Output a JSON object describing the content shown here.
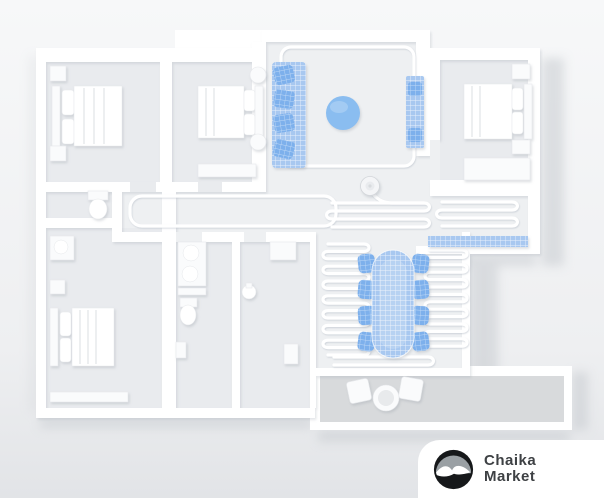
{
  "logo": {
    "brand_line1": "Chaika",
    "brand_line2": "Market",
    "icon": "seagull-icon"
  },
  "colors": {
    "bgTop": "#f7f8f9",
    "bgMid": "#eeeff1",
    "bgBottom": "#e2e4e7",
    "wall": "#ffffff",
    "floor": "#e9ebee",
    "floorLight": "#eef0f2",
    "balconyFloor": "#d8dadc",
    "shadow": "#c3c7cc",
    "pathLine": "#ffffff",
    "blueLight": "#a8c8f0",
    "blueMid": "#8abdf0",
    "blueDark": "#7db0ec",
    "furn": "#fafbfc",
    "furnEdge": "#e6e8eb",
    "robot": "#f4f5f7",
    "logoText": "#3e4144",
    "logoCircle": "#16181a",
    "logoSky": "#9aa0a4"
  },
  "scene": {
    "kind": "3d-apartment-floorplan-render",
    "rooms": [
      "bedroom-top-left",
      "bedroom-top-middle",
      "living-room",
      "bedroom-top-right",
      "corridor",
      "hallway-right",
      "wc",
      "bathroom",
      "kitchen",
      "bedroom-bottom-left",
      "dining-room",
      "balcony"
    ],
    "highlighted_items": [
      "sofa",
      "ottoman-pouf",
      "tv-console",
      "dining-table",
      "dining-chairs",
      "hallway-runner-rug"
    ],
    "robot": "robot-vacuum",
    "path_style": "serpentine-cleaning-path"
  }
}
